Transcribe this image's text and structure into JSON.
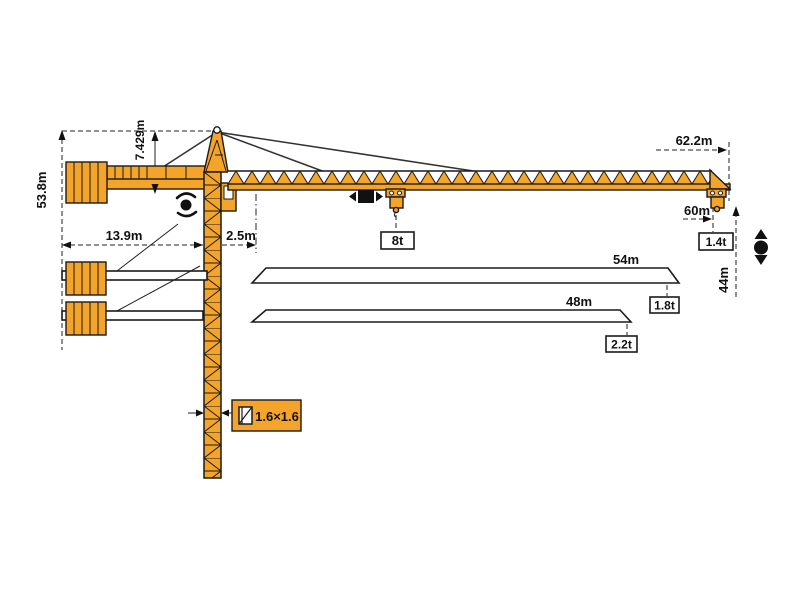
{
  "diagram": {
    "title": "Tower crane working range and load diagram",
    "colors": {
      "crane_orange": "#F5A42A",
      "line_black": "#1A1A1A",
      "background": "#FFFFFF"
    },
    "labels": {
      "total_height": "53.8m",
      "tower_head_height": "7.429m",
      "counter_jib_length": "13.9m",
      "jib_root_offset": "2.5m",
      "max_jib_length": "62.2m",
      "working_radius_60": "60m",
      "under_hook_height": "44m",
      "max_capacity": "8t",
      "tip_load_60m": "1.4t",
      "jib_option_54": "54m",
      "tip_load_54m": "1.8t",
      "jib_option_48": "48m",
      "tip_load_48m": "2.2t",
      "mast_cross_section": "1.6×1.6"
    },
    "icons": [
      "slewing-icon",
      "trolley-travel-icon",
      "hoisting-icon",
      "mast-section-icon"
    ]
  }
}
